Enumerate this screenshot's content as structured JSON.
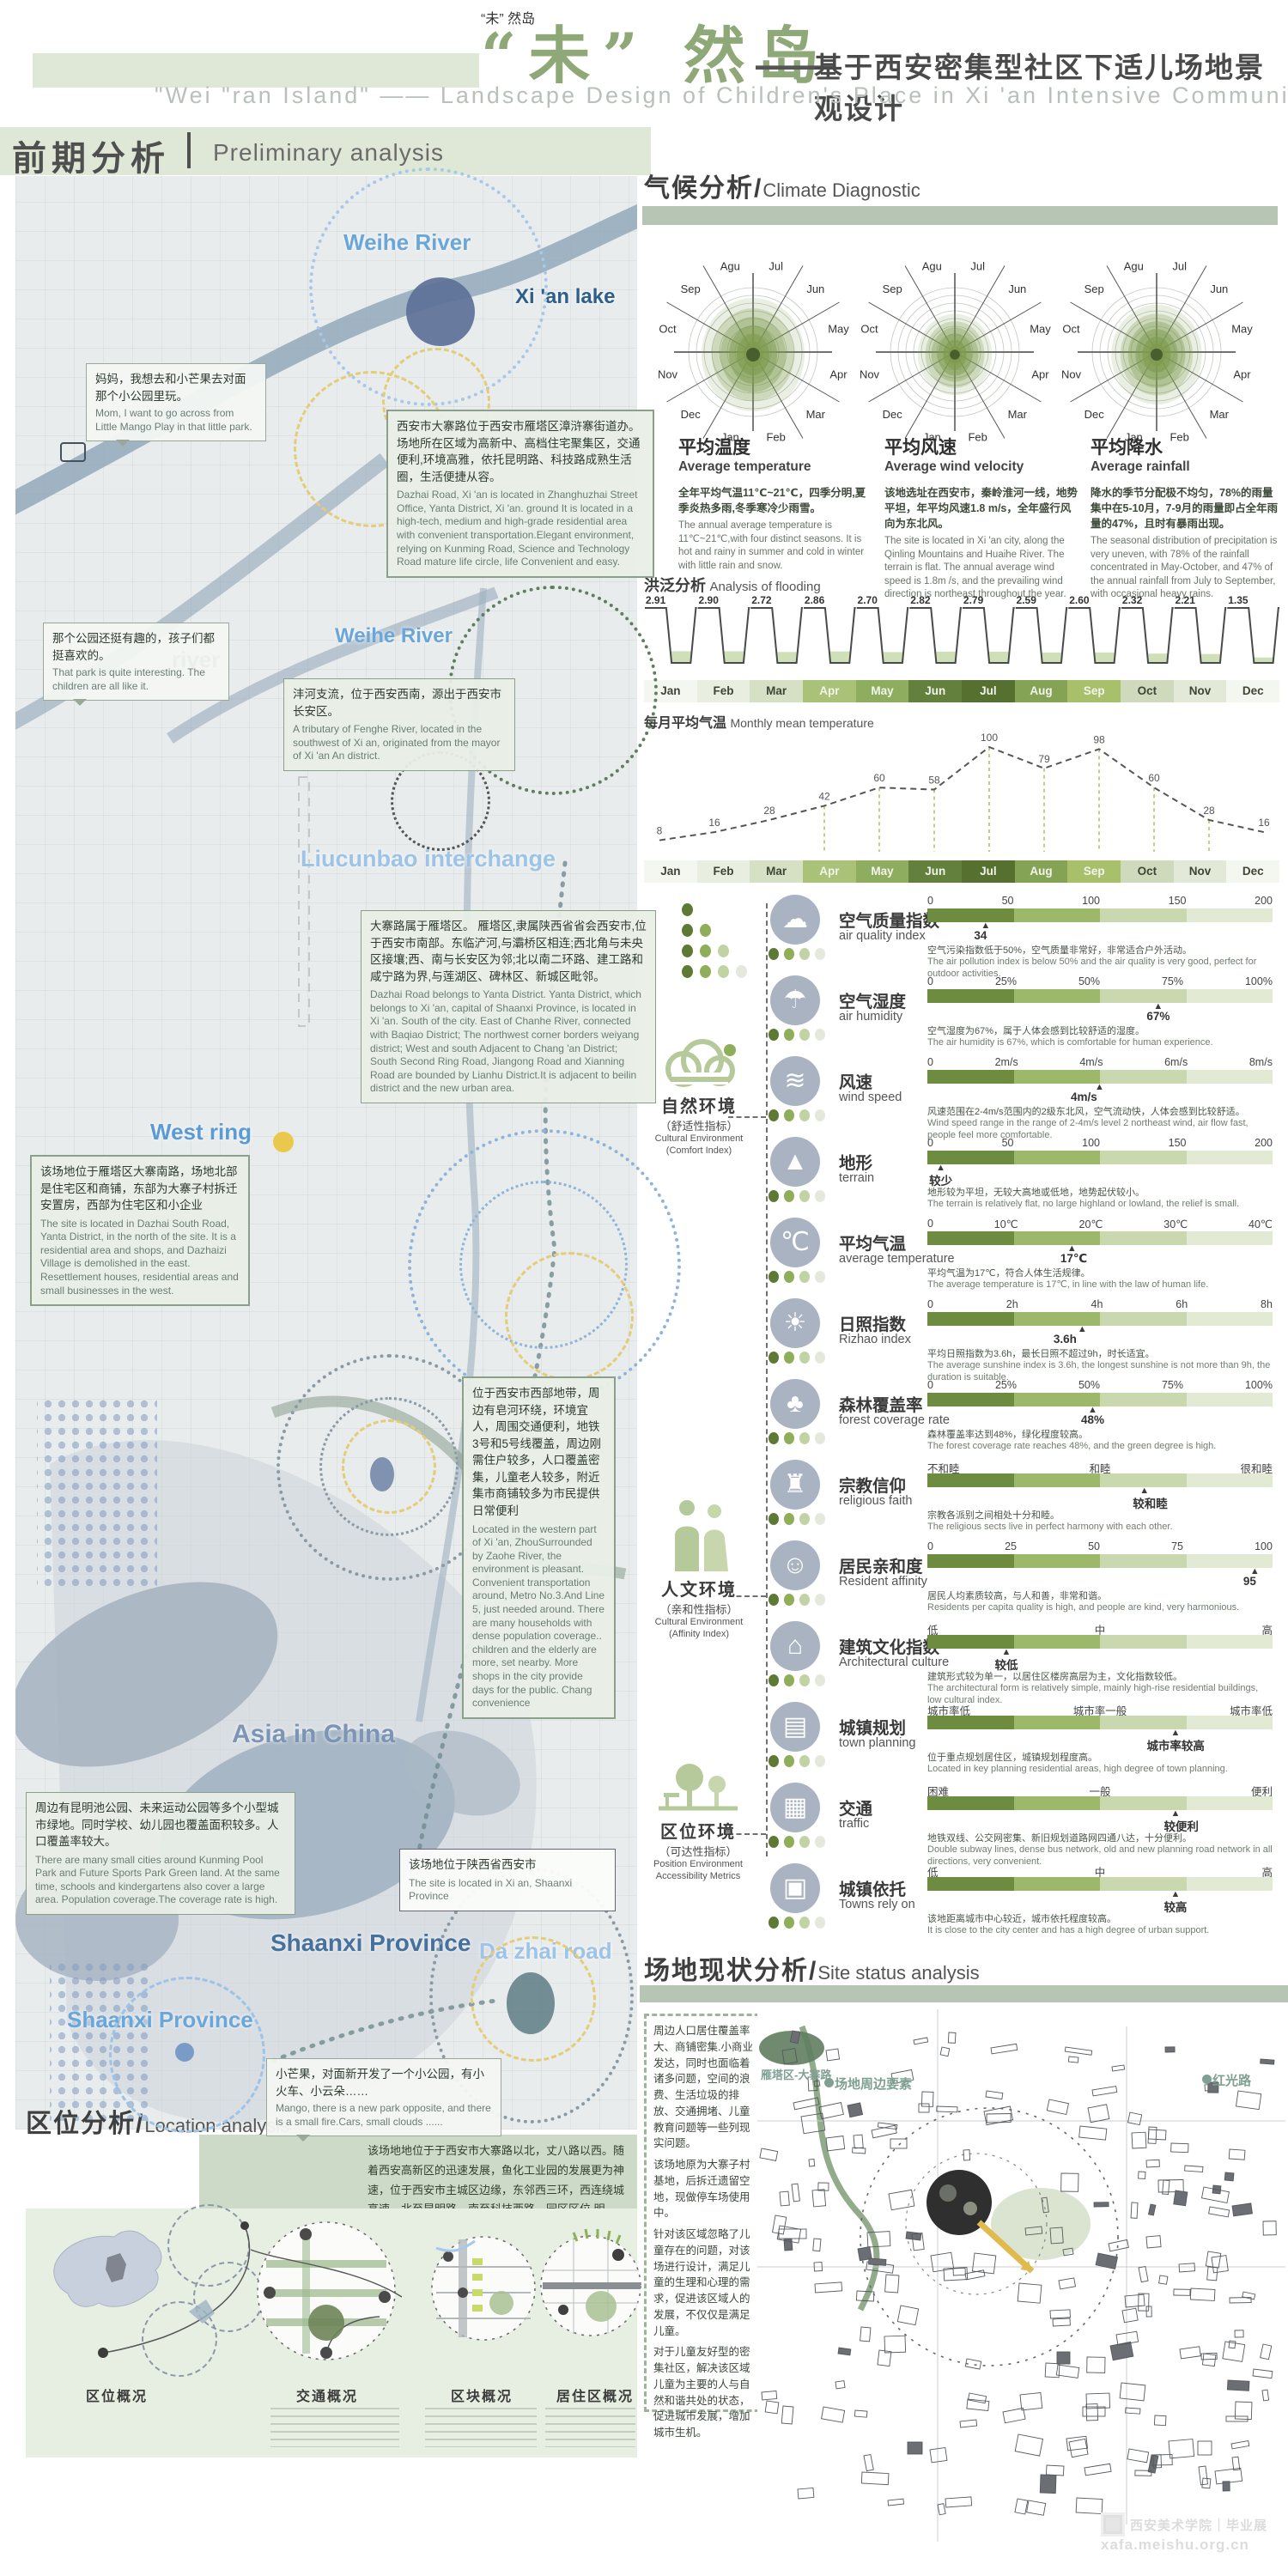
{
  "title": {
    "main_cn": "“未” 然岛",
    "dash": "——",
    "subtitle_cn": "基于西安密集型社区下适儿场地景观设计",
    "subtitle_en": "\"Wei \"ran Island\" —— Landscape Design of Children's Place in Xi 'an Intensive Community"
  },
  "sections": {
    "preliminary_cn": "前期分析",
    "preliminary_en": "Preliminary analysis",
    "climate_cn": "气候分析/",
    "climate_en": "Climate Diagnostic",
    "flooding_cn": "洪泛分析",
    "flooding_en": "Analysis of flooding",
    "monthly_cn": "每月平均气温",
    "monthly_en": "Monthly mean temperature",
    "site_cn": "场地现状分析/",
    "site_en": "Site status analysis",
    "location_cn": "区位分析/",
    "location_en": "Location analysis"
  },
  "climate": {
    "rose_months": [
      "Jul",
      "Jun",
      "May",
      "Apr",
      "Mar",
      "Feb",
      "Jan",
      "Dec",
      "Nov",
      "Oct",
      "Sep",
      "Agu"
    ],
    "rose_scales": [
      1,
      0.72,
      0.88
    ],
    "roses": [
      {
        "title_cn": "平均温度",
        "title_en": "Average temperature",
        "desc_cn": "全年平均气温11℃~21℃，四季分明,夏季炎热多雨,冬季寒冷少雨雪。",
        "desc_en": "The annual average temperature is 11℃~21℃,with four distinct seasons. It is hot and rainy in summer and cold in winter with little rain and snow."
      },
      {
        "title_cn": "平均风速",
        "title_en": "Average wind velocity",
        "desc_cn": "该地选址在西安市，秦岭淮河一线，地势平坦，年平均风速1.8 m/s，全年盛行风向为东北风。",
        "desc_en": "The site is located in Xi 'an city, along the Qinling Mountains and Huaihe River. The terrain is flat. The annual average wind speed is 1.8m /s, and the prevailing wind direction is northeast throughout the year."
      },
      {
        "title_cn": "平均降水",
        "title_en": "Average rainfall",
        "desc_cn": "降水的季节分配极不均匀，78%的雨量集中在5-10月，7-9月的雨量即占全年雨量的47%，且时有暴雨出现。",
        "desc_en": "The seasonal distribution of precipitation is very uneven, with 78% of the rainfall concentrated in May-October, and 47% of the annual rainfall from July to September, with occasional heavy rains."
      }
    ]
  },
  "chart_data": [
    {
      "type": "bar",
      "name": "flooding",
      "title": "洪泛分析 Analysis of flooding",
      "categories": [
        "Jan",
        "Feb",
        "Mar",
        "Apr",
        "May",
        "Jun",
        "Jul",
        "Aug",
        "Sep",
        "Oct",
        "Nov",
        "Dec"
      ],
      "values": [
        2.91,
        2.9,
        2.72,
        2.86,
        2.7,
        2.82,
        2.79,
        2.59,
        2.6,
        2.32,
        2.21,
        1.35
      ]
    },
    {
      "type": "line",
      "name": "monthly-mean-temperature",
      "title": "每月平均气温 Monthly mean temperature",
      "categories": [
        "Jan",
        "Feb",
        "Mar",
        "Apr",
        "May",
        "Jun",
        "Jul",
        "Aug",
        "Sep",
        "Oct",
        "Nov",
        "Dec"
      ],
      "values": [
        8,
        16,
        28,
        42,
        60,
        58,
        100,
        79,
        98,
        60,
        28,
        16
      ],
      "ylim": [
        0,
        100
      ]
    },
    {
      "type": "polar",
      "name": "wind-rose-months",
      "months": [
        "Jul",
        "Jun",
        "May",
        "Apr",
        "Mar",
        "Feb",
        "Jan",
        "Dec",
        "Nov",
        "Oct",
        "Sep",
        "Agu"
      ],
      "charts": [
        "平均温度 Average temperature",
        "平均风速 Average wind velocity",
        "平均降水 Average rainfall"
      ]
    }
  ],
  "months": [
    {
      "label": "Jan",
      "color": "#f4f6f0",
      "dark": false
    },
    {
      "label": "Feb",
      "color": "#e8eee0",
      "dark": false
    },
    {
      "label": "Mar",
      "color": "#d5e0c4",
      "dark": false
    },
    {
      "label": "Apr",
      "color": "#a9c277",
      "dark": true
    },
    {
      "label": "May",
      "color": "#8fad5e",
      "dark": true
    },
    {
      "label": "Jun",
      "color": "#63803c",
      "dark": true
    },
    {
      "label": "Jul",
      "color": "#55702f",
      "dark": true
    },
    {
      "label": "Aug",
      "color": "#85a355",
      "dark": true
    },
    {
      "label": "Sep",
      "color": "#a9c06b",
      "dark": true
    },
    {
      "label": "Oct",
      "color": "#cfdabc",
      "dark": false
    },
    {
      "label": "Nov",
      "color": "#e2e9d6",
      "dark": false
    },
    {
      "label": "Dec",
      "color": "#f4f6f0",
      "dark": false
    }
  ],
  "env_groups": [
    {
      "cn": "自然环境",
      "sub": "（舒适性指标）",
      "en1": "Cultural Environment",
      "en2": "(Comfort Index)"
    },
    {
      "cn": "人文环境",
      "sub": "（亲和性指标）",
      "en1": "Cultural Environment",
      "en2": "(Affinity Index)"
    },
    {
      "cn": "区位环境",
      "sub": "（可达性指标）",
      "en1": "Position Environment",
      "en2": "Accessibility Metrics"
    }
  ],
  "indicators": [
    {
      "icon": "air-quality-icon",
      "glyph": "☁",
      "cn": "空气质量指数",
      "en": "air quality index",
      "scale": [
        "0",
        "50",
        "100",
        "150",
        "200"
      ],
      "marker": "34",
      "marker_pos": 0.17,
      "desc_cn": "空气污染指数低于50%，空气质量非常好，非常适合户外活动。",
      "desc_en": "The air pollution index is below 50% and the air quality is very good, perfect for outdoor activities."
    },
    {
      "icon": "humidity-icon",
      "glyph": "☂",
      "cn": "空气湿度",
      "en": "air humidity",
      "scale": [
        "0",
        "25%",
        "50%",
        "75%",
        "100%"
      ],
      "marker": "67%",
      "marker_pos": 0.67,
      "desc_cn": "空气湿度为67%，属于人体会感到比较舒适的湿度。",
      "desc_en": "The air humidity is 67%, which is comfortable for human experience."
    },
    {
      "icon": "wind-icon",
      "glyph": "≋",
      "cn": "风速",
      "en": "wind speed",
      "scale": [
        "0",
        "2m/s",
        "4m/s",
        "6m/s",
        "8m/s"
      ],
      "marker": "4m/s",
      "marker_pos": 0.5,
      "desc_cn": "风速范围在2-4m/s范围内的2级东北风，空气流动快，人体会感到比较舒适。",
      "desc_en": "Wind speed range in the range of 2-4m/s level 2 northeast wind, air flow fast, people feel more comfortable."
    },
    {
      "icon": "terrain-icon",
      "glyph": "▲",
      "cn": "地形",
      "en": "terrain",
      "scale": [
        "0",
        "50",
        "100",
        "150",
        "200"
      ],
      "marker": "较少",
      "marker_pos": 0.04,
      "desc_cn": "地形较为平坦，无较大高地或低地，地势起伏较小。",
      "desc_en": "The terrain is relatively flat, no large highland or lowland, the relief is small."
    },
    {
      "icon": "thermometer-icon",
      "glyph": "℃",
      "cn": "平均气温",
      "en": "average temperature",
      "scale": [
        "0",
        "10℃",
        "20℃",
        "30℃",
        "40℃"
      ],
      "marker": "17℃",
      "marker_pos": 0.42,
      "desc_cn": "平均气温为17℃，符合人体生活规律。",
      "desc_en": "The average temperature is 17℃, in line with the law of human life."
    },
    {
      "icon": "sunshine-icon",
      "glyph": "☀",
      "cn": "日照指数",
      "en": "Rizhao index",
      "scale": [
        "0",
        "2h",
        "4h",
        "6h",
        "8h"
      ],
      "marker": "3.6h",
      "marker_pos": 0.45,
      "desc_cn": "平均日照指数为3.6h，最长日照不超过9h，时长适宜。",
      "desc_en": "The average sunshine index is 3.6h, the longest sunshine is not more than 9h, the duration is suitable."
    },
    {
      "icon": "forest-icon",
      "glyph": "♣",
      "cn": "森林覆盖率",
      "en": "forest coverage rate",
      "scale": [
        "0",
        "25%",
        "50%",
        "75%",
        "100%"
      ],
      "marker": "48%",
      "marker_pos": 0.48,
      "desc_cn": "森林覆盖率达到48%，绿化程度较高。",
      "desc_en": "The forest coverage rate reaches 48%, and the green degree is high."
    },
    {
      "icon": "church-icon",
      "glyph": "♜",
      "cn": "宗教信仰",
      "en": "religious faith",
      "scale": [
        "不和睦",
        "和睦",
        "很和睦"
      ],
      "marker": "较和睦",
      "marker_pos": 0.63,
      "desc_cn": "宗教各派别之间相处十分和睦。",
      "desc_en": "The religious sects live in perfect harmony with each other."
    },
    {
      "icon": "people-icon",
      "glyph": "☺",
      "cn": "居民亲和度",
      "en": "Resident affinity",
      "scale": [
        "0",
        "25",
        "50",
        "75",
        "100"
      ],
      "marker": "95",
      "marker_pos": 0.95,
      "desc_cn": "居民人均素质较高，与人和善，非常和谐。",
      "desc_en": "Residents per capita quality is high, and people are kind, very harmonious."
    },
    {
      "icon": "building-icon",
      "glyph": "⌂",
      "cn": "建筑文化指数",
      "en": "Architectural culture",
      "scale": [
        "低",
        "中",
        "高"
      ],
      "marker": "较低",
      "marker_pos": 0.23,
      "desc_cn": "建筑形式较为单一，以居住区楼房高层为主，文化指数较低。",
      "desc_en": "The architectural form is relatively simple, mainly high-rise residential buildings, low cultural index."
    },
    {
      "icon": "plan-icon",
      "glyph": "▤",
      "cn": "城镇规划",
      "en": "town planning",
      "scale": [
        "城市率低",
        "城市率一般",
        "城市率低"
      ],
      "marker": "城市率较高",
      "marker_pos": 0.72,
      "desc_cn": "位于重点规划居住区，城镇规划程度高。",
      "desc_en": "Located in key planning residential areas, high degree of town planning."
    },
    {
      "icon": "traffic-light-icon",
      "glyph": "▦",
      "cn": "交通",
      "en": "traffic",
      "scale": [
        "困难",
        "一般",
        "便利"
      ],
      "marker": "较便利",
      "marker_pos": 0.72,
      "desc_cn": "地铁双线、公交网密集、新旧规划道路网四通八达，十分便利。",
      "desc_en": "Double subway lines, dense bus network, old and new planning road network in all directions, very convenient."
    },
    {
      "icon": "town-icon",
      "glyph": "▣",
      "cn": "城镇依托",
      "en": "Towns rely on",
      "scale": [
        "低",
        "中",
        "高"
      ],
      "marker": "较高",
      "marker_pos": 0.72,
      "desc_cn": "该地距离城市中心较近，城市依托程度较高。",
      "desc_en": "It is close to the city center and has a high degree of urban support."
    }
  ],
  "map": {
    "labels": [
      {
        "text": "Weihe River"
      },
      {
        "text": "Xi 'an lake"
      },
      {
        "text": "Weihe River"
      },
      {
        "text": "river"
      },
      {
        "text": "Liucunbao interchange"
      },
      {
        "text": "West ring"
      },
      {
        "text": "Asia in China"
      },
      {
        "text": "Shaanxi Province"
      },
      {
        "text": "Shaanxi Province"
      },
      {
        "text": "Da zhai road"
      }
    ],
    "annotations": [
      {
        "cn": "妈妈，我想去和小芒果去对面那个小公园里玩。",
        "en": "Mom, I want to go across from Little Mango Play in that little park."
      },
      {
        "cn": "西安市大寨路位于西安市雁塔区漳浒寨街道办。场地所在区域为高新中、高档住宅聚集区，交通便利,环境高雅，依托昆明路、科技路成熟生活圈，生活便捷从容。",
        "en": "Dazhai Road, Xi 'an is located in Zhanghuzhai Street Office, Yanta District, Xi 'an. ground It is located in a high-tech, medium and high-grade residential area with convenient transportation.Elegant environment, relying on Kunming Road, Science and Technology Road mature life circle, life Convenient and easy."
      },
      {
        "cn": "那个公园还挺有趣的，孩子们都挺喜欢的。",
        "en": "That park is quite interesting. The children are all like it."
      },
      {
        "cn": "沣河支流，位于西安西南，源出于西安市长安区。",
        "en": "A tributary of Fenghe River, located in the southwest of Xi an, originated from the mayor of Xi 'an An district."
      },
      {
        "cn": "大寨路属于雁塔区。 雁塔区,隶属陕西省省会西安市,位于西安市南部。东临浐河,与灞桥区相连;西北角与未央区接壤;西、南与长安区为邻;北以南二环路、建工路和咸宁路为界,与莲湖区、碑林区、新城区毗邻。",
        "en": "Dazhai Road belongs to Yanta District. Yanta District, which belongs to Xi 'an, capital of Shaanxi Province, is located in Xi 'an. South of the city. East of Chanhe River, connected with Baqiao District; The northwest corner borders weiyang district; West and south Adjacent to Chang 'an District; South Second Ring Road, Jiangong Road and Xianning Road are bounded by Lianhu District.It is adjacent to beilin district and the new urban area."
      },
      {
        "cn": "该场地位于雁塔区大寨南路，场地北部是住宅区和商铺，东部为大寨子村拆迁安置房，西部为住宅区和小企业",
        "en": "The site is located in Dazhai South Road, Yanta District, in the north of the site. It is a residential area and shops, and Dazhaizi Village is demolished in the east. Resettlement houses, residential areas and small businesses in the west."
      },
      {
        "cn": "位于西安市西部地带，周边有皂河环绕，环境宜人，周围交通便利，地铁3号和5号线覆盖，周边刚需住户较多，人口覆盖密集，儿童老人较多，附近集市商铺较多为市民提供日常便利",
        "en": "Located in the western part of Xi 'an, ZhouSurrounded by Zaohe River, the environment is pleasant. Convenient transportation around, Metro No.3.And Line 5, just needed around. There are many households with dense population coverage.. children and the elderly are more, set nearby. More shops in the city provide days for the public. Chang convenience"
      },
      {
        "cn": "该场地位于陕西省西安市",
        "en": "The site is located in Xi an, Shaanxi Province"
      },
      {
        "cn": "周边有昆明池公园、未来运动公园等多个小型城市绿地。同时学校、幼儿园也覆盖面积较多。人口覆盖率较大。",
        "en": "There are many small cities around Kunming Pool Park and Future Sports Park Green land. At the same time, schools and kindergartens also cover a large area. Population coverage.The coverage rate is high."
      },
      {
        "cn": "小芒果，对面新开发了一个小公园，有小火车、小云朵……",
        "en": "Mango, there is a new park opposite, and there is a small fire.Cars, small clouds ......"
      }
    ]
  },
  "site_status": {
    "left_text_cn": [
      "周边人口居住覆盖率大、商铺密集.小商业发达，同时也面临着诸多问题，空间的浪费、生活垃圾的排放、交通拥堵、儿童教育问题等一些列现实问题。",
      "该场地原为大寨子村基地，后拆迁遗留空地，现做停车场使用中。",
      "针对该区域忽略了儿童存在的问题，对该场进行设计，满足儿童的生理和心理的需求，促进该区域人的发展，不仅仅是满足儿童。",
      "对于儿童友好型的密集社区，解决该区域儿童为主要的人与自然和谐共处的状态，促进城市发展，增加城市生机。"
    ],
    "map_labels": [
      "场地周边要素",
      "红光路",
      "雁塔区-大寨路"
    ]
  },
  "location": {
    "paragraph": "该场地地位于于西安市大寨路以北，丈八路以西。随着西安高新区的迅速发展，鱼化工业园的发展更为神速，位于西安市主城区边缘，东邻西三环，西连绕城高速，北至昆明路，南至科技西路，园区区位 明显，交通便捷，充满无限商机。",
    "diagrams": [
      "区位概况",
      "交通概况",
      "区块概况",
      "居住区概况"
    ]
  },
  "watermark": {
    "cn": "西安美术学院｜毕业展",
    "url": "xafa.meishu.org.cn"
  },
  "colors": {
    "bar_segments": [
      "#6d8c3f",
      "#9cb86b",
      "#c9d8ae",
      "#e2ead4"
    ],
    "dots": [
      "#5d7a35",
      "#8fae5a",
      "#c2d3a3",
      "#e4e9dc"
    ],
    "accent_green": "#8fa878",
    "band_green": "#a9bba7",
    "pale_green": "#dfe8d6"
  }
}
